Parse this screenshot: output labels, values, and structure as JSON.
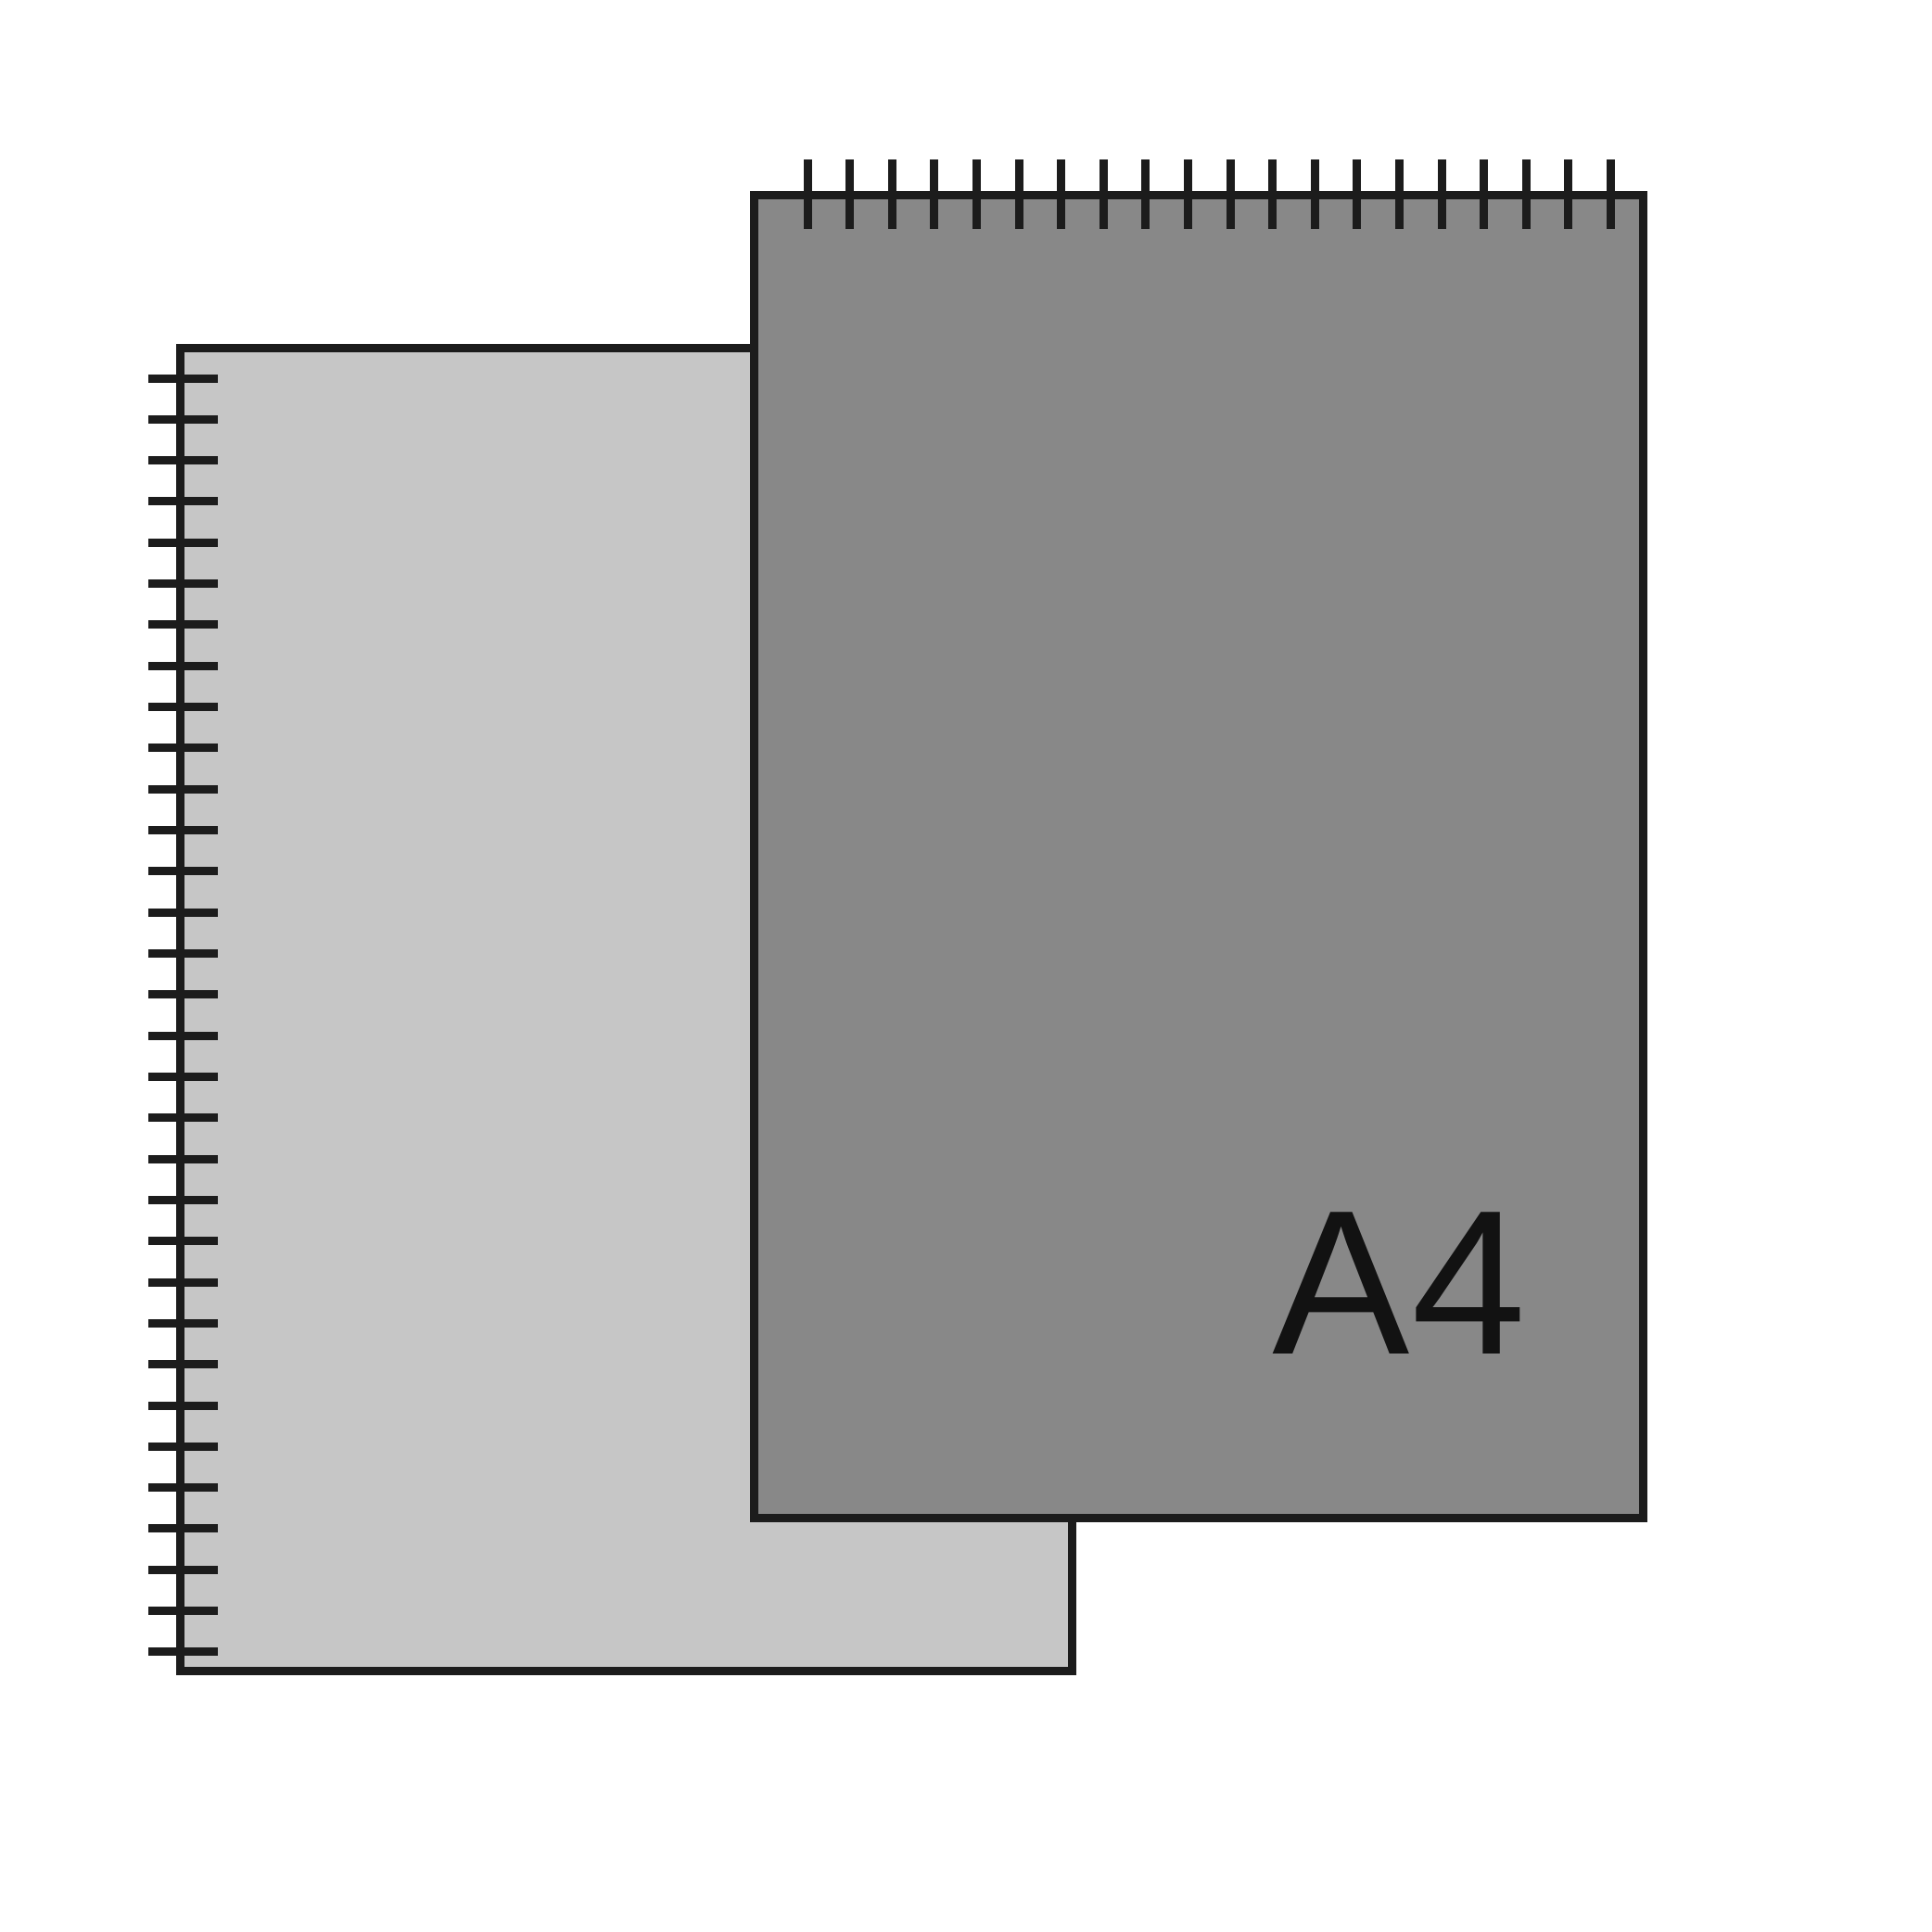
{
  "illustration": {
    "background_color": "#ffffff",
    "outline_color": "#1c1c1c",
    "back_pad": {
      "fill_color": "#c6c6c6",
      "binding_side": "left",
      "ring_count": 32,
      "label": ""
    },
    "front_pad": {
      "fill_color": "#888888",
      "binding_side": "top",
      "ring_count": 20,
      "label": "A4",
      "label_color": "#121212"
    }
  }
}
